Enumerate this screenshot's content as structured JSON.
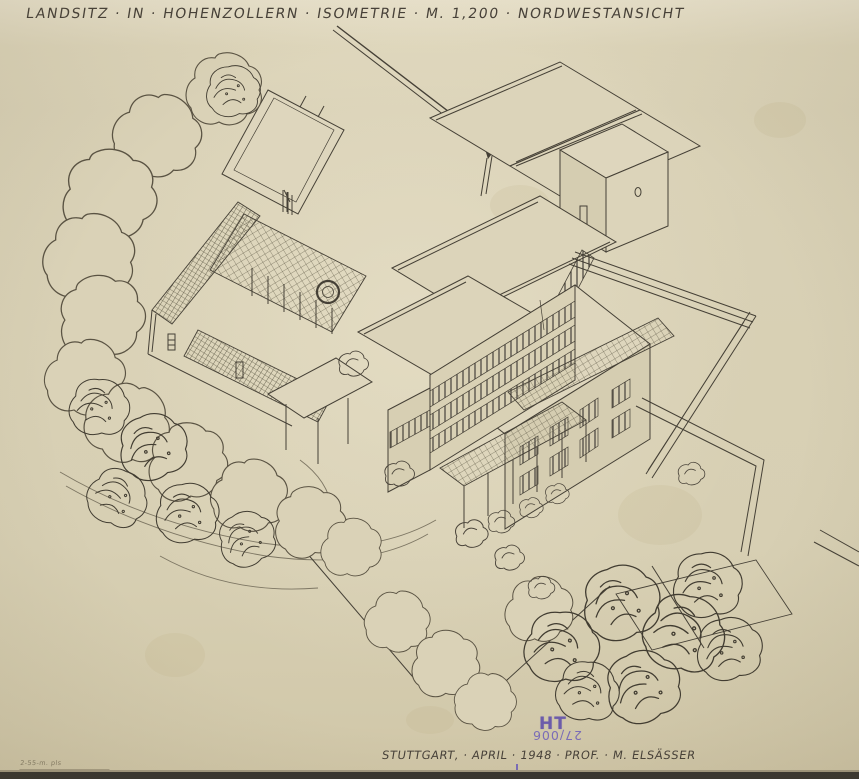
{
  "document": {
    "title": "LANDSITZ · IN · HOHENZOLLERN · ISOMETRIE · M. 1,200 · NORDWESTANSICHT",
    "caption": "STUTTGART, · APRIL · 1948 · PROF. · M. ELSÄSSER",
    "stamp": {
      "letters": "HT",
      "number": "27/006"
    },
    "pencil_note": "2-55-m. pls",
    "drawing_description": "Hand-drawn isometric ink drawing of a flat-roofed country estate seen from the northwest, with walled garden, pergola courtyards, a three-storey wing with ribbon windows, terraces, boundary walls, curved drive and surrounding sketched trees"
  },
  "colors": {
    "paper": "#d9d1b6",
    "ink": "#454036",
    "pencil": "#7d7663",
    "stamp_purple": "#6c5cab"
  }
}
